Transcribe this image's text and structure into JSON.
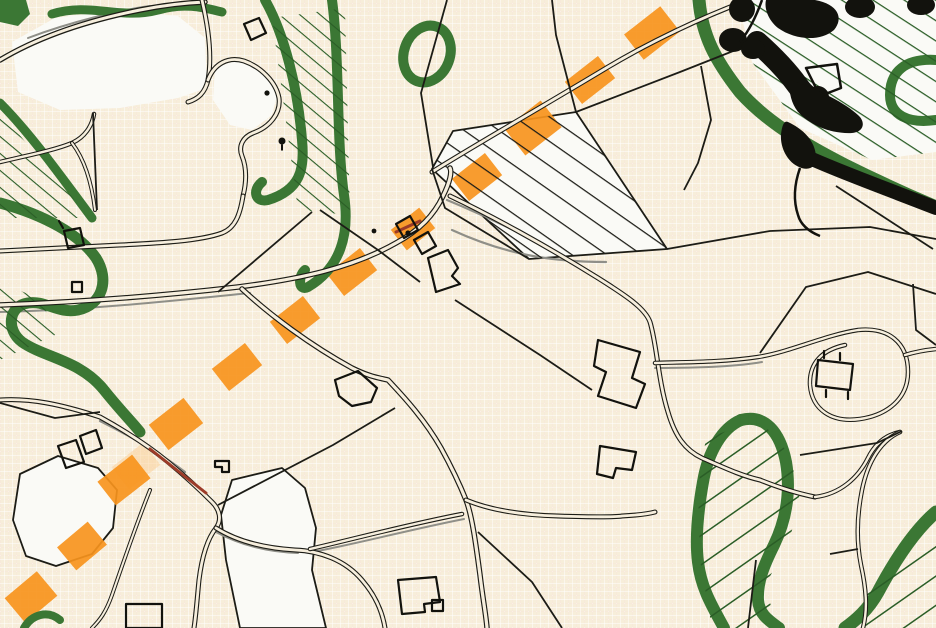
{
  "palette": {
    "bg": "#f7eeda",
    "bg_road": "#f6eedd",
    "grid_line": "rgba(223,162,106,0.33)",
    "grid_hi": "rgba(255,255,255,0.5)",
    "white_field": "#fafaf6",
    "green": "#3b7734",
    "green_dark": "#2a5d26",
    "ink": "#1c1c16",
    "ink_dark": "#12120d",
    "gray": "#8f8f88",
    "orange": "#f7941d",
    "orange_halo": "#fbc98a",
    "red_road": "#9c3b28"
  },
  "map": {
    "white_fields": [
      {
        "pts": "12,42 55,18 120,10 178,16 205,38 207,88 178,98 120,108 60,110 18,92",
        "outlined": false
      },
      {
        "pts": "432,169 453,131 576,112 667,249 529,259",
        "outlined": true
      },
      {
        "pts": "738,0 936,0 936,152 872,160 800,128 752,62",
        "outlined": false
      },
      {
        "pts": "20,474 58,456 98,468 117,490 113,528 92,554 56,566 26,556 13,520",
        "outlined": true
      },
      {
        "pts": "232,480 282,468 305,488 316,528 312,570 326,628 240,628 226,560 221,515",
        "outlined": true
      },
      {
        "pts": "215,68 238,60 262,68 278,92 272,115 252,130 230,125 213,100",
        "outlined": false
      }
    ],
    "route_markers": [
      {
        "x": 652,
        "y": 33,
        "w": 46,
        "h": 32,
        "a": -38,
        "halo": false
      },
      {
        "x": 590,
        "y": 80,
        "w": 42,
        "h": 28,
        "a": -38,
        "halo": false
      },
      {
        "x": 533,
        "y": 128,
        "w": 46,
        "h": 34,
        "a": -38,
        "halo": false
      },
      {
        "x": 477,
        "y": 177,
        "w": 42,
        "h": 28,
        "a": -38,
        "halo": false
      },
      {
        "x": 413,
        "y": 229,
        "w": 36,
        "h": 26,
        "a": -38,
        "halo": false
      },
      {
        "x": 352,
        "y": 272,
        "w": 42,
        "h": 28,
        "a": -38,
        "halo": false
      },
      {
        "x": 295,
        "y": 320,
        "w": 42,
        "h": 28,
        "a": -38,
        "halo": false
      },
      {
        "x": 237,
        "y": 367,
        "w": 42,
        "h": 28,
        "a": -38,
        "halo": false
      },
      {
        "x": 176,
        "y": 424,
        "w": 44,
        "h": 32,
        "a": -38,
        "halo": false
      },
      {
        "x": 136,
        "y": 466,
        "w": 40,
        "h": 28,
        "a": -38,
        "halo": true
      },
      {
        "x": 124,
        "y": 480,
        "w": 44,
        "h": 30,
        "a": -38,
        "halo": false
      },
      {
        "x": 82,
        "y": 546,
        "w": 40,
        "h": 30,
        "a": -40,
        "halo": false
      },
      {
        "x": 31,
        "y": 597,
        "w": 42,
        "h": 32,
        "a": -40,
        "halo": false
      }
    ],
    "hatch_overlays": [
      {
        "pts": "432,169 453,131 576,112 667,249 529,259",
        "pattern": "hatchBlack"
      },
      {
        "pts": "738,0 936,0 936,152 872,160 800,128 752,62",
        "pattern": "hatchGreen"
      },
      {
        "pts": "272,18 345,8 350,215 298,210",
        "pattern": "hatchGreenFine"
      },
      {
        "pts": "0,112 90,218 0,218",
        "pattern": "hatchGreenFine"
      },
      {
        "pts": "0,282 42,300 55,335 0,360",
        "pattern": "hatchGreenFine"
      },
      {
        "pts": "706,438 760,420 790,455 800,500 788,545 765,585 775,620 770,628 712,628 700,560 698,488",
        "pattern": "hatchGreenSW"
      },
      {
        "pts": "880,570 936,520 936,628 850,628",
        "pattern": "hatchGreenSW"
      }
    ],
    "green_bands": [
      {
        "d": "M52,14 C90,2 120,20 158,10 C185,2 205,8 222,12",
        "w": 9
      },
      {
        "d": "M265,0 C285,35 298,90 302,140 C305,170 300,190 268,200 C255,203 252,190 262,182",
        "w": 10
      },
      {
        "d": "M332,0 C340,60 336,140 344,195 C350,235 340,268 308,287 C298,292 298,276 305,270",
        "w": 10
      },
      {
        "d": "M0,203 C45,215 80,235 96,258 C110,280 102,305 78,310 C58,314 45,300 28,303 C8,306 6,330 22,342 C45,358 80,360 104,390 C120,410 132,422 140,432",
        "w": 11
      },
      {
        "d": "M0,103 C30,133 60,175 92,218",
        "w": 9
      },
      {
        "d": "M699,0 C702,35 715,60 740,92 C765,120 800,142 845,165 C885,185 915,198 936,207",
        "w": 13
      },
      {
        "d": "M936,60 C905,58 890,72 890,95 C890,115 908,124 936,120",
        "w": 10
      },
      {
        "d": "M741,420 C765,414 780,432 786,462 C791,492 786,520 774,545 C764,565 757,582 758,600 C759,614 768,620 779,628",
        "w": 12
      },
      {
        "d": "M741,420 C722,428 708,452 703,482 C698,510 695,538 698,562 C701,588 712,606 724,628",
        "w": 12
      },
      {
        "d": "M936,512 C915,530 895,560 878,592 C868,610 856,620 845,628",
        "w": 13
      },
      {
        "d": "M24,628 C32,614 48,610 60,620",
        "w": 8
      }
    ],
    "green_rings": [
      {
        "cx": 427,
        "cy": 54,
        "rx": 23,
        "ry": 29,
        "rot": 20,
        "w": 10
      }
    ],
    "green_blobs": [
      {
        "pts": "0,0 26,0 30,14 18,26 0,22"
      }
    ],
    "gray_lines": [
      {
        "d": "M452,230 C500,252 545,262 606,262",
        "w": 2.2
      },
      {
        "d": "M0,312 C90,310 180,300 250,293",
        "w": 2
      },
      {
        "d": "M447,200 C500,222 560,252 612,285",
        "w": 2.2
      },
      {
        "d": "M216,532 C240,545 268,552 298,553",
        "w": 2
      },
      {
        "d": "M655,368 C700,368 740,366 762,362",
        "w": 2
      },
      {
        "d": "M28,38 C70,22 120,10 150,6",
        "w": 2
      },
      {
        "d": "M100,421 C130,436 160,453 185,472",
        "w": 2.2
      },
      {
        "d": "M312,552 C352,545 408,530 464,519",
        "w": 2
      }
    ],
    "roads": [
      {
        "d": "M0,60 C40,36 90,20 140,10 C160,6 180,3 205,2",
        "ow": 5.5,
        "iw": 3
      },
      {
        "d": "M202,0 C209,30 212,58 208,80 C205,93 198,99 188,102",
        "ow": 5,
        "iw": 2.8
      },
      {
        "d": "M208,80 C214,64 228,56 244,61 C261,67 276,82 279,98 C281,113 270,127 253,133 C243,137 238,146 242,156 C246,166 247,180 243,196",
        "ow": 5,
        "iw": 2.8
      },
      {
        "d": "M243,196 C240,215 235,228 222,233 C200,241 160,243 120,245 C80,247 40,249 0,251",
        "ow": 5,
        "iw": 2.8
      },
      {
        "d": "M0,162 C30,155 55,150 72,143 C85,137 92,126 94,114",
        "ow": 4.5,
        "iw": 2.4
      },
      {
        "d": "M72,143 C85,160 92,185 95,210",
        "ow": 4,
        "iw": 2
      },
      {
        "d": "M0,305 C80,302 160,296 238,287 C300,279 352,268 396,243 C420,230 434,215 443,196 C450,182 452,172 450,168",
        "ow": 5.5,
        "iw": 3.2
      },
      {
        "d": "M432,172 C470,148 540,108 608,67 C650,42 700,18 748,0",
        "ow": 5,
        "iw": 2.8
      },
      {
        "d": "M450,196 C490,215 545,245 598,278 C625,295 645,308 650,322 C657,345 658,380 668,412 C675,436 685,450 702,458 C725,468 742,476 760,480 C785,490 800,494 815,497",
        "ow": 5,
        "iw": 2.8
      },
      {
        "d": "M815,497 C840,494 858,478 868,458 C875,444 885,435 900,432",
        "ow": 4.5,
        "iw": 2.4
      },
      {
        "d": "M900,432 C882,440 868,460 862,490 C857,515 856,540 861,565 C866,588 868,608 863,628",
        "ow": 4.5,
        "iw": 2.4
      },
      {
        "d": "M655,363 C690,362 725,362 758,357 C790,352 825,335 858,330 C888,327 908,342 908,372 C908,398 888,415 860,419 C832,423 812,410 810,385 C809,363 822,350 845,345",
        "ow": 4.5,
        "iw": 2.4
      },
      {
        "d": "M905,355 C915,352 926,350 936,349",
        "ow": 4.5,
        "iw": 2.4
      },
      {
        "d": "M0,400 C30,398 60,404 100,417 C120,428 145,443 168,462 C185,476 200,490 212,502 C220,510 222,520 216,528 C208,538 202,556 199,580 C197,600 196,615 194,628",
        "ow": 5,
        "iw": 2.8
      },
      {
        "d": "M216,528 C235,540 262,548 295,550 C320,551 345,560 362,580 C375,595 382,610 385,628",
        "ow": 5,
        "iw": 2.8
      },
      {
        "d": "M310,549 C350,540 405,525 462,514",
        "ow": 4.5,
        "iw": 2.4
      },
      {
        "d": "M150,490 C138,520 124,560 112,595 C106,612 100,620 92,628",
        "ow": 4,
        "iw": 2
      },
      {
        "d": "M242,289 C270,315 310,345 352,368 C370,377 380,378 388,380 C405,398 425,420 441,448 C452,468 460,485 466,500 C472,515 476,545 480,575 C483,600 486,615 487,628",
        "ow": 5.5,
        "iw": 3.2
      },
      {
        "d": "M466,500 C490,510 520,515 558,516 C590,517 615,517 622,516 C640,515 648,514 655,512",
        "ow": 5,
        "iw": 2.8
      }
    ],
    "parcel_lines": [
      {
        "d": "M447,0 L421,93 L433,167"
      },
      {
        "d": "M576,112 L556,35 L552,0"
      },
      {
        "d": "M576,112 L680,72 L756,42"
      },
      {
        "d": "M667,249 L770,231 L870,227 L936,239"
      },
      {
        "d": "M836,186 L933,249"
      },
      {
        "d": "M701,66 L711,120 L698,163 L684,190"
      },
      {
        "d": "M218,292 L312,212"
      },
      {
        "d": "M93,113 L97,210"
      },
      {
        "d": "M320,210 L378,250 L420,282"
      },
      {
        "d": "M455,300 L540,355 L592,390"
      },
      {
        "d": "M760,353 L806,287 L868,272 L936,294"
      },
      {
        "d": "M913,284 L916,330 L936,345"
      },
      {
        "d": "M800,455 L877,443 L902,431"
      },
      {
        "d": "M830,554 L858,549"
      },
      {
        "d": "M0,403 L55,418 L100,412"
      },
      {
        "d": "M478,532 L532,582 L562,628"
      },
      {
        "d": "M218,505 L333,445 L395,408"
      },
      {
        "d": "M756,560 L748,628"
      },
      {
        "d": "M529,259 L445,208 L432,169"
      }
    ],
    "red_lines": [
      {
        "d": "M150,449 L206,493",
        "w": 3
      },
      {
        "d": "M396,232 L420,221",
        "w": 3
      }
    ],
    "black_bands": [
      {
        "d": "M796,152 C840,172 890,190 936,208",
        "w": 14
      },
      {
        "d": "M757,42 C775,58 788,72 798,86 C806,97 812,100 818,97",
        "w": 22
      }
    ],
    "blobs": [
      {
        "type": "circle",
        "cx": 742,
        "cy": 9,
        "r": 13
      },
      {
        "type": "path",
        "d": "M766,0 L815,0 C838,4 844,18 834,30 C820,42 795,40 778,28 C768,20 764,8 766,0 Z"
      },
      {
        "type": "ellipse",
        "cx": 860,
        "cy": 7,
        "rx": 15,
        "ry": 11
      },
      {
        "type": "ellipse",
        "cx": 921,
        "cy": 5,
        "rx": 14,
        "ry": 10
      },
      {
        "type": "ellipse",
        "cx": 733,
        "cy": 40,
        "rx": 14,
        "ry": 12
      },
      {
        "type": "ellipse",
        "cx": 753,
        "cy": 49,
        "rx": 12,
        "ry": 10
      },
      {
        "type": "path",
        "d": "M790,80 C820,90 845,103 858,115 C866,122 864,132 852,133 C832,134 812,126 800,114 C792,106 788,92 790,80 Z"
      },
      {
        "type": "path",
        "d": "M788,122 C805,130 815,142 816,156 C817,168 808,172 797,166 C786,160 780,146 781,134 C782,126 784,120 788,122 Z"
      }
    ],
    "wires": [
      {
        "d": "M762,0 C755,20 748,32 740,42",
        "w": 2.5
      },
      {
        "d": "M800,168 C794,185 793,200 798,215 C801,226 810,232 820,236",
        "w": 2.5
      },
      {
        "d": "M806,68 L837,64 L841,88 L820,96 Z",
        "w": 2.5
      }
    ],
    "buildings": [
      {
        "d": "M64,231 L80,228 L84,245 L68,248 Z"
      },
      {
        "d": "M63,228 L59,221"
      },
      {
        "d": "M72,282 L82,282 L82,292 L72,292 Z"
      },
      {
        "d": "M396,224 L410,216 L418,230 L404,238 Z"
      },
      {
        "d": "M414,240 L428,232 L436,246 L422,254 Z"
      },
      {
        "d": "M428,258 L448,250 L458,268 L452,276 L460,284 L436,292 Z"
      },
      {
        "d": "M335,380 L358,371 L377,388 L371,402 L352,406 L339,396 Z"
      },
      {
        "d": "M598,340 L640,352 L632,378 L645,384 L636,408 L598,396 L606,372 L594,366 Z"
      },
      {
        "d": "M600,446 L636,452 L632,470 L616,468 L613,478 L597,474 Z"
      },
      {
        "d": "M818,360 L853,364 L850,390 L816,386 Z"
      },
      {
        "d": "M824,358 L824,351"
      },
      {
        "d": "M840,360 L840,353"
      },
      {
        "d": "M848,392 L848,399"
      },
      {
        "d": "M826,390 L826,397"
      },
      {
        "d": "M58,446 L76,440 L84,462 L66,468 Z"
      },
      {
        "d": "M80,436 L96,430 L102,448 L86,454 Z"
      },
      {
        "d": "M126,604 L162,604 L162,628 L126,628 Z"
      },
      {
        "d": "M398,580 L436,577 L440,602 L424,604 L425,612 L402,614 Z"
      },
      {
        "d": "M432,600 L443,600 L443,611 L432,611 Z"
      },
      {
        "d": "M215,461 L229,461 L229,472 L222,472 L222,467 L215,467 Z"
      },
      {
        "d": "M244,24 L259,18 L266,33 L251,40 Z"
      }
    ],
    "dots": [
      {
        "cx": 408,
        "cy": 233,
        "r": 2.6
      },
      {
        "cx": 374,
        "cy": 231,
        "r": 2.4
      },
      {
        "cx": 267,
        "cy": 93,
        "r": 2.6
      }
    ],
    "tree_symbols": [
      {
        "cx": 282,
        "cy": 141,
        "r": 3.5
      }
    ]
  }
}
